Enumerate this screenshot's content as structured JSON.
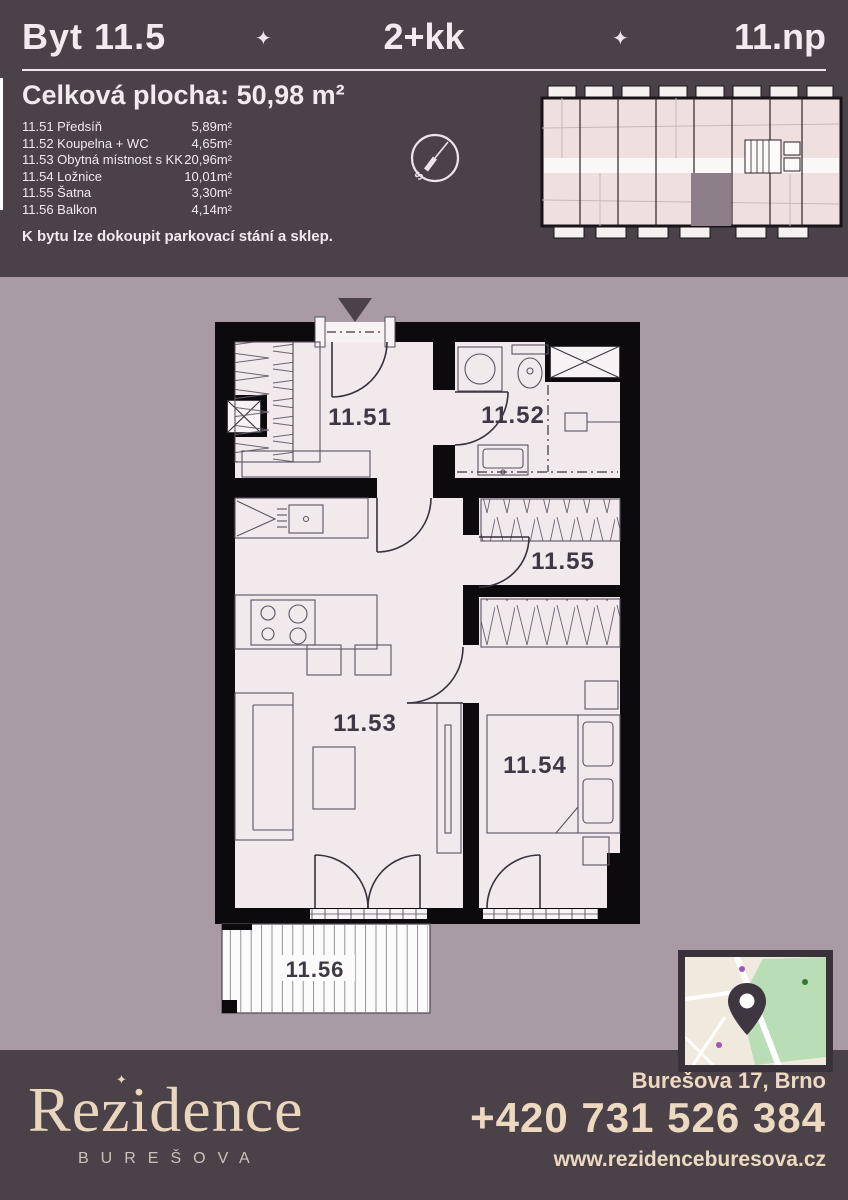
{
  "header": {
    "unit": "Byt 11.5",
    "separator": "✦",
    "layout": "2+kk",
    "floor": "11.np"
  },
  "summary": {
    "label": "Celková plocha:",
    "value": "50,98 m²"
  },
  "rooms": [
    {
      "code": "11.51",
      "name": "Předsíň",
      "area": "5,89m²"
    },
    {
      "code": "11.52",
      "name": "Koupelna + WC",
      "area": "4,65m²"
    },
    {
      "code": "11.53",
      "name": "Obytná místnost s KK",
      "area": "20,96m²"
    },
    {
      "code": "11.54",
      "name": "Ložnice",
      "area": "10,01m²"
    },
    {
      "code": "11.55",
      "name": "Šatna",
      "area": "3,30m²"
    },
    {
      "code": "11.56",
      "name": "Balkon",
      "area": "4,14m²"
    }
  ],
  "note": "K bytu lze dokoupit parkovací stání a sklep.",
  "compass": {
    "south_label": "S"
  },
  "plan": {
    "labels": {
      "r51": "11.51",
      "r52": "11.52",
      "r53": "11.53",
      "r54": "11.54",
      "r55": "11.55",
      "r56": "11.56"
    }
  },
  "footer": {
    "brand": "Rezidence",
    "brand_mark": "✦",
    "brand_sub": "BUREŠOVA",
    "address": "Burešova 17, Brno",
    "phone": "+420 731 526 384",
    "website": "www.rezidenceburesova.cz"
  },
  "colors": {
    "dark": "#4a4149",
    "mauve": "#a89ba3",
    "cream": "#ecd9c0",
    "room_fill": "#f1e9eb",
    "wall": "#0d0a0e",
    "highlight_unit": "#8d7f89"
  }
}
